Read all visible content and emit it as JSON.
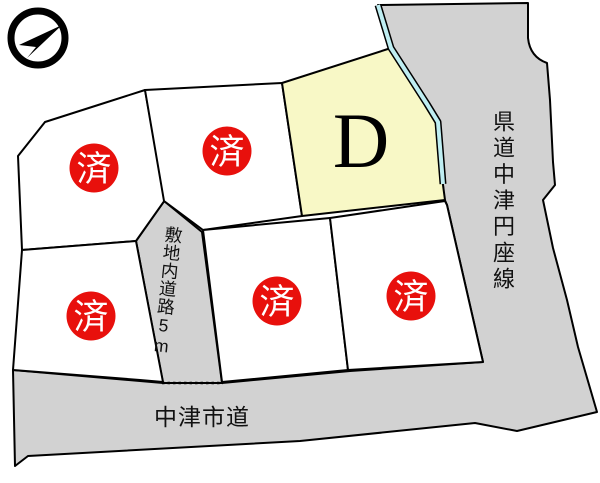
{
  "compass": {
    "icon": "north-arrow-icon"
  },
  "plots": {
    "featured": {
      "label": "D"
    },
    "sold": [
      {
        "position": "upper-left",
        "label": "済"
      },
      {
        "position": "upper-middle",
        "label": "済"
      },
      {
        "position": "lower-left",
        "label": "済"
      },
      {
        "position": "lower-middle",
        "label": "済"
      },
      {
        "position": "lower-right",
        "label": "済"
      }
    ]
  },
  "roads": {
    "prefectural_label": "県道中津円座線",
    "city_label": "中津市道",
    "internal_label": "敷地内道路5m"
  },
  "colors": {
    "road_fill": "#d2d2d2",
    "featured_plot_fill": "#f8f8c6",
    "sold_plot_fill": "#ffffff",
    "boundary_line": "#000000",
    "water_edge_line": "#bfeef2",
    "sold_badge_fill": "#e8100c",
    "sold_badge_text": "#ffffff"
  }
}
